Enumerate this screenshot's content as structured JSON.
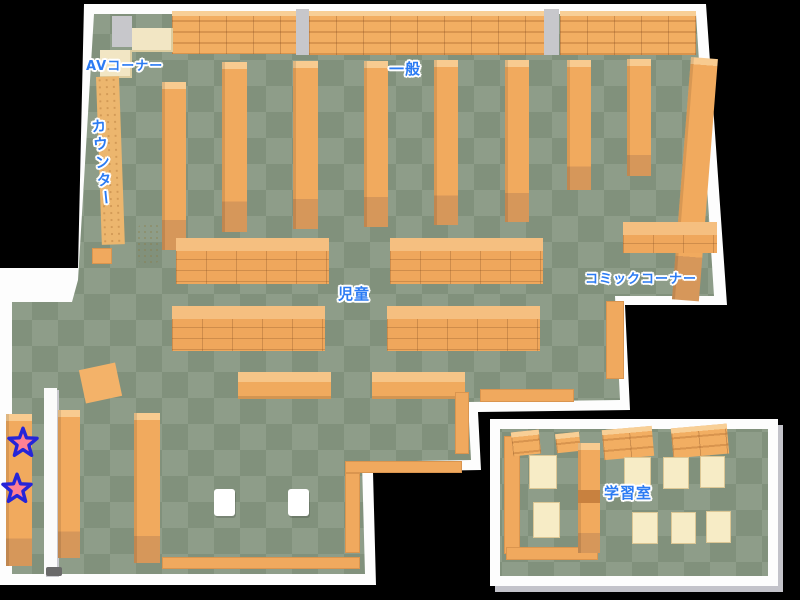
{
  "page": {
    "type": "library-floor-map",
    "background": "#000000"
  },
  "areas": {
    "av_corner": {
      "label": "AVコーナー"
    },
    "general": {
      "label": "一般"
    },
    "counter": {
      "label": "カウンター"
    },
    "children": {
      "label": "児童"
    },
    "comic_corner": {
      "label": "コミックコーナー"
    },
    "study_room": {
      "label": "学習室"
    }
  },
  "markers": {
    "stars": [
      {
        "id": "star-marker-1"
      },
      {
        "id": "star-marker-2"
      }
    ],
    "fill": "#ff8093",
    "outline": "#2525d8"
  },
  "colors": {
    "floor_light": "#8e9d89",
    "floor_dark": "#81917c",
    "shelf_orange": "#f1aa5e",
    "shelf_top": "#f8cb90",
    "counter_wood": "#ecb66e",
    "desk_cream": "#f7ecc6",
    "wall_white": "#fdfdfd",
    "label_blue": "#2b7bf3"
  }
}
